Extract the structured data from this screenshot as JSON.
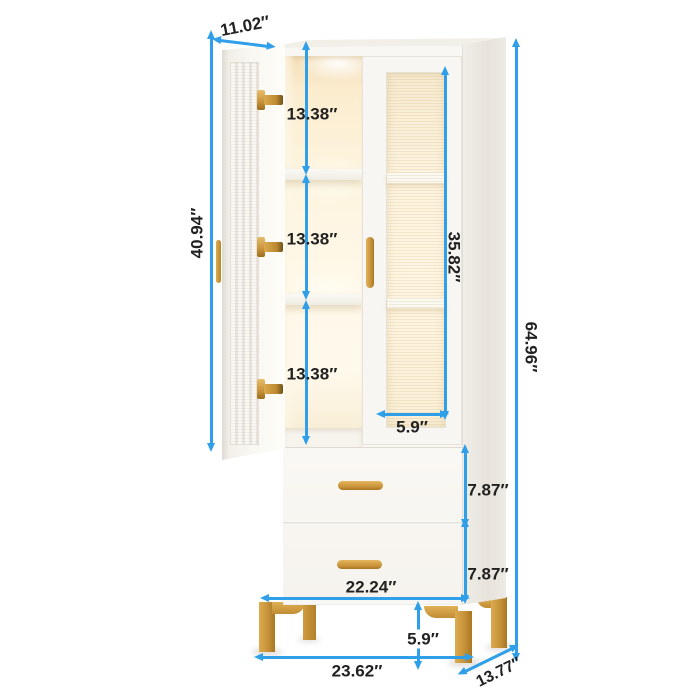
{
  "figure": {
    "type": "product-dimension-diagram",
    "product": "tall white bookcase display cabinet with two fluted-glass doors, LED-lit shelves, two drawers and gold metal legs",
    "colors": {
      "background": "#ffffff",
      "dimension_line": "#2f9fe9",
      "dimension_text": "#212121",
      "cabinet_front": "#f9f7f3",
      "cabinet_side": "#ebe7e0",
      "interior_glow": "#fdf3dc",
      "gold_accent": "#c8923a"
    },
    "labels": {
      "door_width": "11.02″",
      "left_door_height": "40.94″",
      "compartment_1": "13.38″",
      "compartment_2": "13.38″",
      "compartment_3": "13.38″",
      "right_glass_height": "35.82″",
      "glass_width": "5.9″",
      "total_height": "64.96″",
      "drawer_1_height": "7.87″",
      "drawer_2_height": "7.87″",
      "drawer_width": "22.24″",
      "leg_height": "5.9″",
      "total_width": "23.62″",
      "total_depth": "13.77″"
    }
  }
}
